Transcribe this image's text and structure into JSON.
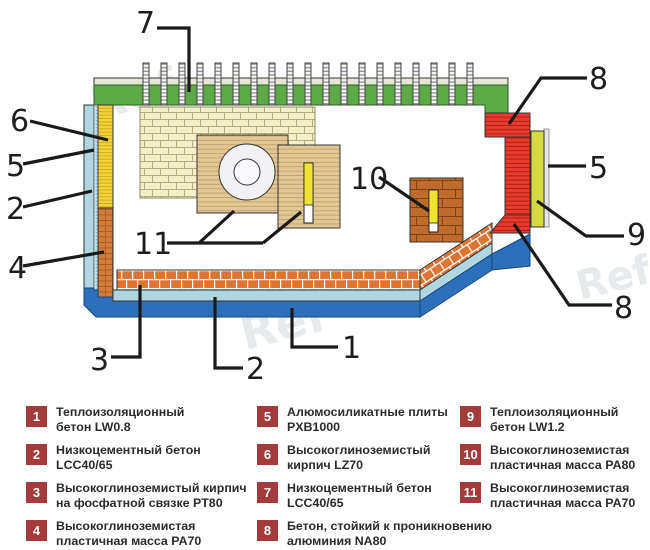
{
  "diagram": {
    "watermark": "Ref",
    "callouts": [
      {
        "label": "7"
      },
      {
        "label": "6"
      },
      {
        "label": "5"
      },
      {
        "label": "2"
      },
      {
        "label": "4"
      },
      {
        "label": "3"
      },
      {
        "label": "2"
      },
      {
        "label": "1"
      },
      {
        "label": "11"
      },
      {
        "label": "10"
      },
      {
        "label": "8"
      },
      {
        "label": "5"
      },
      {
        "label": "9"
      },
      {
        "label": "8"
      }
    ],
    "colors": {
      "roof_green": "#5caa44",
      "red_concrete": "#e73b2e",
      "wall_yellow": "#f2d139",
      "olive_strip": "#d5d841",
      "light_blue_concrete": "#aed7e2",
      "dark_blue_concrete": "#2e6fba",
      "floor_brick_orange": "#dd7433",
      "pale_brick": "#f3efc8",
      "tan_block": "#e0c793",
      "brown_block": "#bf6b2d",
      "legend_badge": "#a43a3a"
    }
  },
  "legend": {
    "items": [
      {
        "num": "1",
        "col": 1,
        "line1": "Теплоизоляционный",
        "line2": "бетон LW0.8"
      },
      {
        "num": "2",
        "col": 1,
        "line1": "Низкоцементный бетон",
        "line2": "LCC40/65"
      },
      {
        "num": "3",
        "col": 1,
        "line1": "Высокоглиноземистый кирпич",
        "line2": "на фосфатной связке PT80"
      },
      {
        "num": "4",
        "col": 1,
        "line1": "Высокоглиноземистая",
        "line2": "пластичная масса PA70"
      },
      {
        "num": "5",
        "col": 2,
        "line1": "Алюмосиликатные плиты",
        "line2": "PXB1000"
      },
      {
        "num": "6",
        "col": 2,
        "line1": "Высокоглиноземистый",
        "line2": "кирпич LZ70"
      },
      {
        "num": "7",
        "col": 2,
        "line1": "Низкоцементный бетон",
        "line2": "LCC40/65"
      },
      {
        "num": "8",
        "col": 2,
        "line1": "Бетон, стойкий к проникновению",
        "line2": "алюминия NA80"
      },
      {
        "num": "9",
        "col": 3,
        "line1": "Теплоизоляционный",
        "line2": "бетон LW1.2"
      },
      {
        "num": "10",
        "col": 3,
        "line1": "Высокоглиноземистая",
        "line2": "пластичная масса PA80"
      },
      {
        "num": "11",
        "col": 3,
        "line1": "Высокоглиноземистая",
        "line2": "пластичная масса PA70"
      }
    ]
  }
}
